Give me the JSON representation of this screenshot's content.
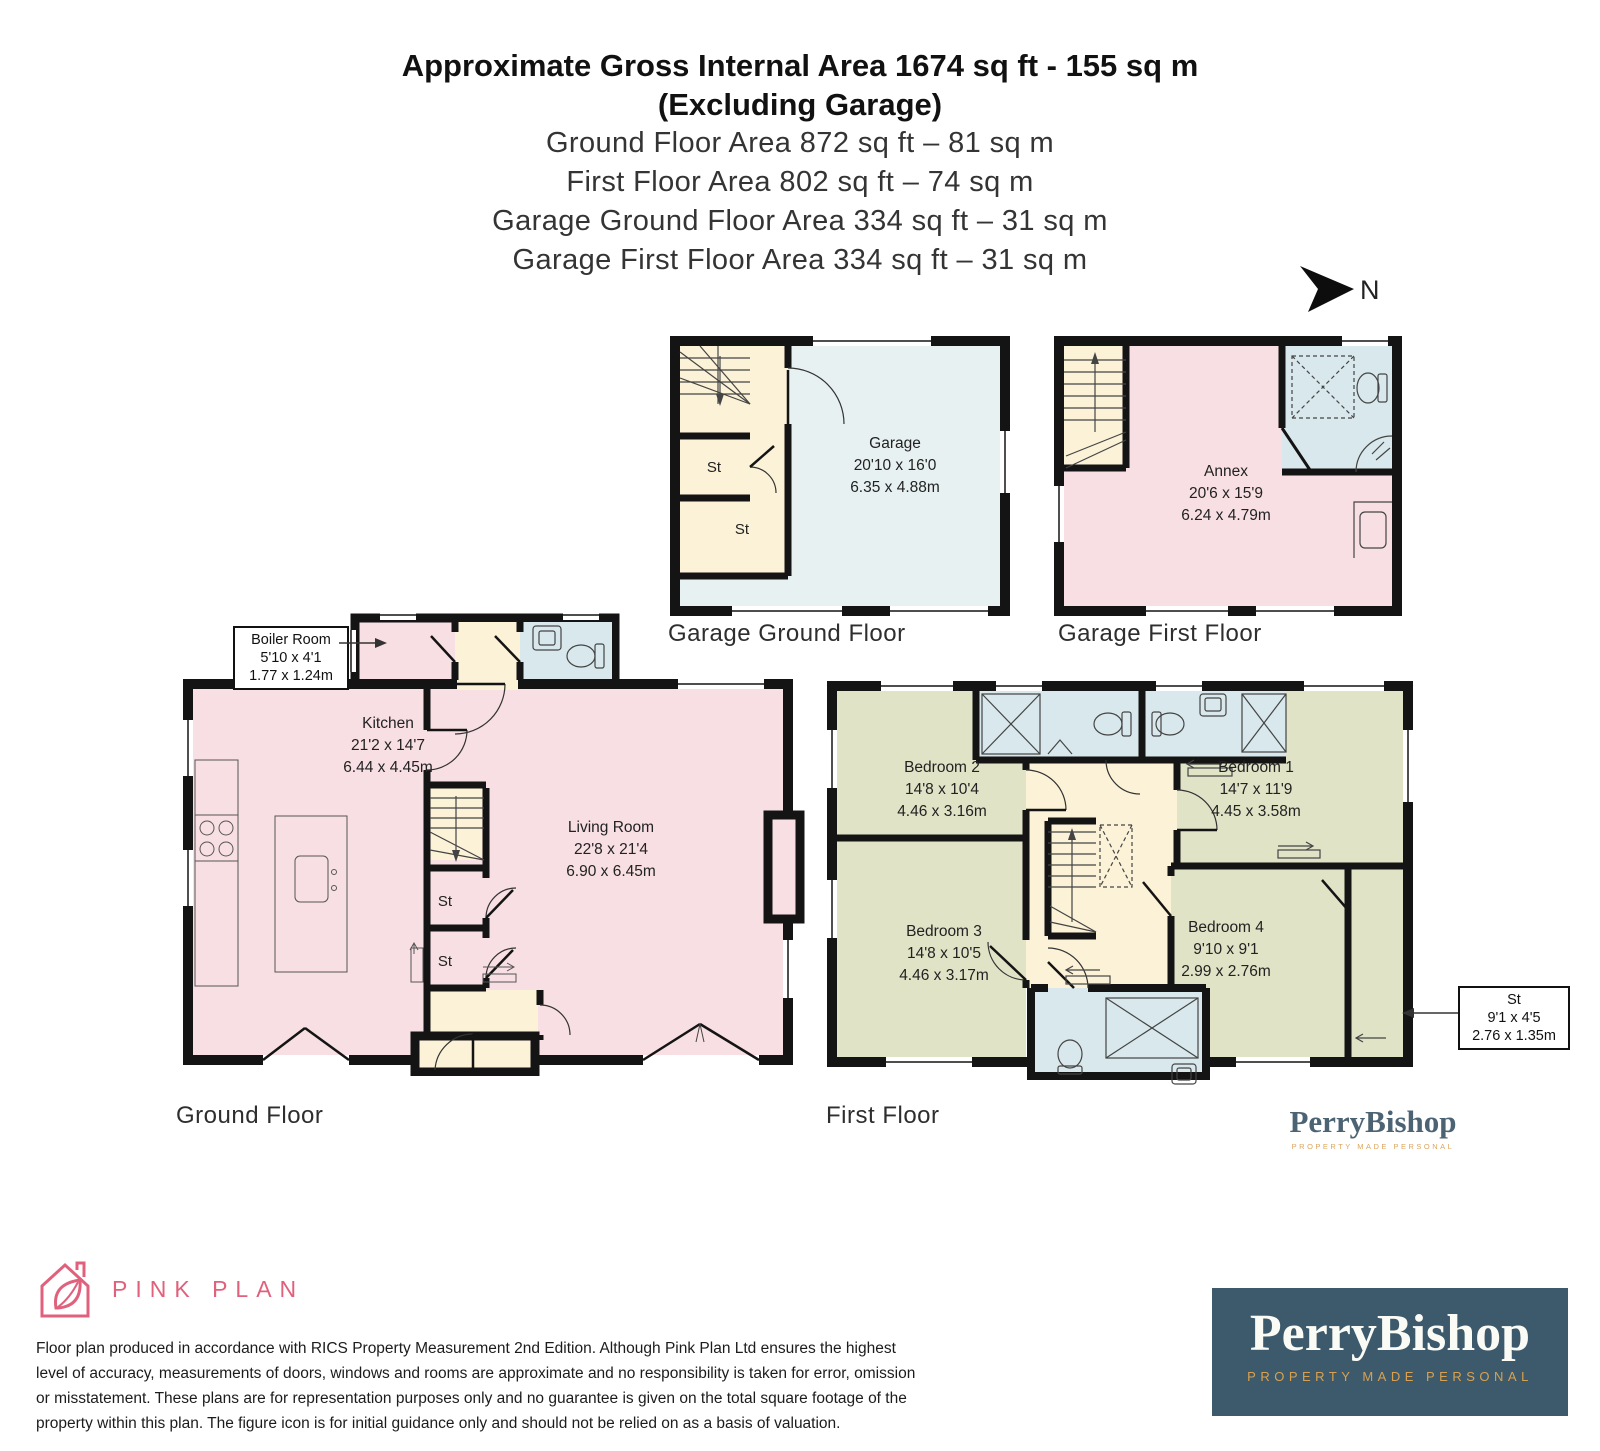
{
  "header": {
    "title_line1": "Approximate Gross Internal Area 1674 sq ft - 155 sq m",
    "title_line2": "(Excluding Garage)",
    "area_lines": [
      "Ground Floor Area 872 sq ft – 81 sq m",
      "First Floor Area 802 sq ft – 74 sq m",
      "Garage Ground Floor Area 334 sq ft – 31 sq m",
      "Garage First Floor Area 334 sq ft – 31 sq m"
    ]
  },
  "compass": {
    "label": "N"
  },
  "plans": {
    "garage_ground": {
      "floor_label": "Garage Ground Floor",
      "room": {
        "name": "Garage",
        "imperial": "20'10 x 16'0",
        "metric": "6.35 x 4.88m"
      },
      "st1": "St",
      "st2": "St"
    },
    "garage_first": {
      "floor_label": "Garage First Floor",
      "room": {
        "name": "Annex",
        "imperial": "20'6 x 15'9",
        "metric": "6.24 x 4.79m"
      }
    },
    "ground": {
      "floor_label": "Ground Floor",
      "boiler": {
        "name": "Boiler Room",
        "imperial": "5'10 x 4'1",
        "metric": "1.77 x 1.24m"
      },
      "kitchen": {
        "name": "Kitchen",
        "imperial": "21'2 x 14'7",
        "metric": "6.44 x 4.45m"
      },
      "living": {
        "name": "Living Room",
        "imperial": "22'8 x 21'4",
        "metric": "6.90 x 6.45m"
      },
      "st1": "St",
      "st2": "St"
    },
    "first": {
      "floor_label": "First Floor",
      "bedroom1": {
        "name": "Bedroom 1",
        "imperial": "14'7 x 11'9",
        "metric": "4.45 x 3.58m"
      },
      "bedroom2": {
        "name": "Bedroom 2",
        "imperial": "14'8 x 10'4",
        "metric": "4.46 x 3.16m"
      },
      "bedroom3": {
        "name": "Bedroom 3",
        "imperial": "14'8 x 10'5",
        "metric": "4.46 x 3.17m"
      },
      "bedroom4": {
        "name": "Bedroom 4",
        "imperial": "9'10 x 9'1",
        "metric": "2.99 x 2.76m"
      },
      "st_callout": {
        "name": "St",
        "imperial": "9'1 x 4'5",
        "metric": "2.76 x 1.35m"
      }
    }
  },
  "branding": {
    "pinkplan": {
      "name": "PINK PLAN"
    },
    "perrybishop_small": {
      "name": "PerryBishop",
      "tagline": "PROPERTY MADE PERSONAL"
    },
    "perrybishop_box": {
      "name": "PerryBishop",
      "tagline": "PROPERTY MADE PERSONAL"
    }
  },
  "disclaimer": "Floor plan produced in accordance with RICS Property Measurement 2nd Edition. Although Pink Plan Ltd ensures the highest level of accuracy, measurements of doors, windows and rooms are approximate and no responsibility is taken for error, omission or misstatement. These plans are for representation purposes only and no guarantee is given on the total square footage of the property within this plan. The figure icon is for initial guidance only and should not be relied on as a basis of valuation.",
  "colors": {
    "room_pink": "#f8dfe3",
    "hall_cream": "#fbf2d7",
    "bath_blue": "#d9e8ec",
    "bedroom_green": "#e1e3c6",
    "garage_blue": "#e8f1f2",
    "wall_black": "#141414",
    "pinkplan_pink": "#e0617c",
    "perrybishop_teal": "#3d5a6c",
    "perrybishop_gold": "#d9a14f"
  }
}
